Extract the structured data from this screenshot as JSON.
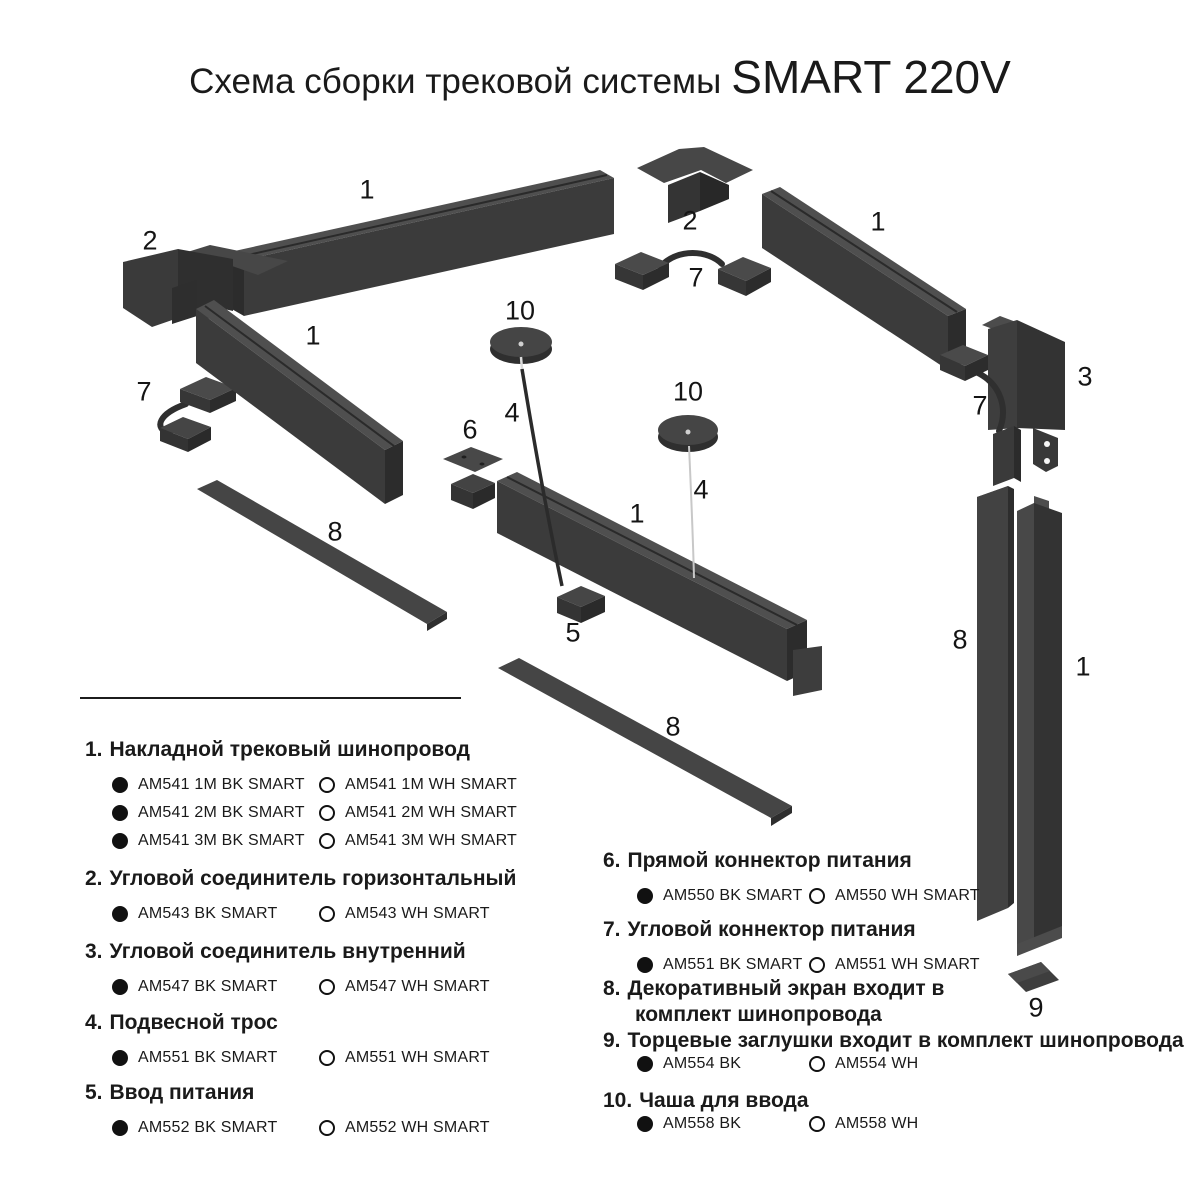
{
  "title": {
    "prefix": "Схема сборки трековой системы",
    "brand": "SMART 220V"
  },
  "colors": {
    "background": "#ffffff",
    "text": "#1a1a1a",
    "part_top": "#4f4f4f",
    "part_front": "#3b3b3b",
    "part_side": "#2c2c2c",
    "cable_dark": "#2f2f2f",
    "cable_light": "#c8c8c8"
  },
  "diagram": {
    "labels": [
      {
        "text": "1"
      },
      {
        "text": "2"
      },
      {
        "text": "1"
      },
      {
        "text": "7"
      },
      {
        "text": "8"
      },
      {
        "text": "10"
      },
      {
        "text": "4"
      },
      {
        "text": "6"
      },
      {
        "text": "5"
      },
      {
        "text": "1"
      },
      {
        "text": "2"
      },
      {
        "text": "7"
      },
      {
        "text": "1"
      },
      {
        "text": "10"
      },
      {
        "text": "4"
      },
      {
        "text": "3"
      },
      {
        "text": "7"
      },
      {
        "text": "8"
      },
      {
        "text": "8"
      },
      {
        "text": "1"
      },
      {
        "text": "9"
      }
    ]
  },
  "legend": {
    "left": [
      {
        "num": "1.",
        "title": "Накладной трековый шинопровод",
        "items": [
          {
            "bk": "AM541 1M BK SMART",
            "wh": "AM541 1M WH SMART"
          },
          {
            "bk": "AM541 2M BK SMART",
            "wh": "AM541 2M WH SMART"
          },
          {
            "bk": "AM541 3M BK SMART",
            "wh": "AM541 3M WH SMART"
          }
        ]
      },
      {
        "num": "2.",
        "title": "Угловой соединитель горизонтальный",
        "items": [
          {
            "bk": "AM543 BK SMART",
            "wh": "AM543 WH SMART"
          }
        ]
      },
      {
        "num": "3.",
        "title": "Угловой соединитель внутренний",
        "items": [
          {
            "bk": "AM547 BK SMART",
            "wh": "AM547 WH SMART"
          }
        ]
      },
      {
        "num": "4.",
        "title": "Подвесной трос",
        "items": [
          {
            "bk": "AM551 BK SMART",
            "wh": "AM551 WH SMART"
          }
        ]
      },
      {
        "num": "5.",
        "title": "Ввод питания",
        "items": [
          {
            "bk": "AM552 BK SMART",
            "wh": "AM552 WH SMART"
          }
        ]
      }
    ],
    "right": [
      {
        "num": "6.",
        "title": "Прямой коннектор питания",
        "items": [
          {
            "bk": "AM550 BK SMART",
            "wh": "AM550 WH SMART"
          }
        ]
      },
      {
        "num": "7.",
        "title": "Угловой коннектор питания",
        "items": [
          {
            "bk": "AM551 BK SMART",
            "wh": "AM551 WH SMART"
          }
        ]
      },
      {
        "num": "8.",
        "title": "Декоративный экран  входит в",
        "title2": "комплект  шинопровода",
        "items": []
      },
      {
        "num": "9.",
        "title": "Торцевые заглушки входит в комплект шинопровода",
        "items": [
          {
            "bk": "AM554 BK",
            "wh": "AM554 WH"
          }
        ]
      },
      {
        "num": "10.",
        "title": "Чаша для ввода",
        "items": [
          {
            "bk": "AM558 BK",
            "wh": "AM558 WH"
          }
        ]
      }
    ]
  }
}
